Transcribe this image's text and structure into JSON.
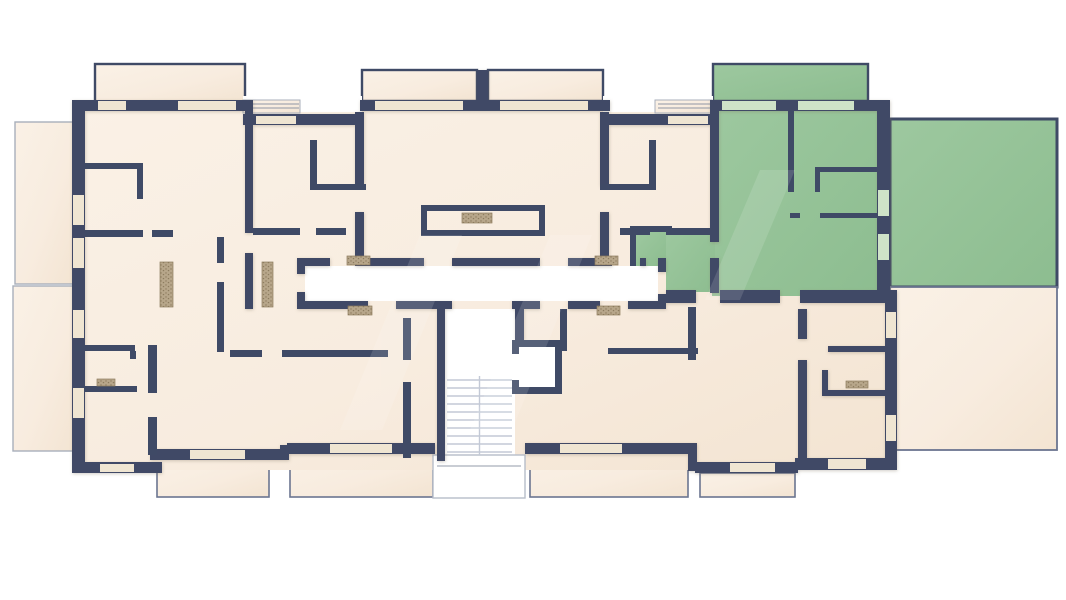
{
  "page": {
    "kind": "architectural-floor-plan",
    "description": "Top-down rendered floor plan of one storey of a residential building. Seven apartment units arranged around a central corridor with staircase and elevator. The upper-right unit and its balcony and large right-hand terrace are highlighted in green (selected/available unit); all other units are beige. Outdoor terraces flank the left side and lower right, balconies line the top and bottom edges. No text labels are rendered on the plan.",
    "background": "#ffffff"
  },
  "colors": {
    "wall": "#3f4a66",
    "wallsoft": "#5b6582",
    "room": "#f8ecdf",
    "roomlight": "#faf1e6",
    "green": "#95c297",
    "greenlight": "#a9cfa9",
    "window": "#efe5d2",
    "windowgreen": "#cfe3c8",
    "thin": "#a9afbb",
    "hatch": "#b7a68a",
    "hatchdot": "#8d7c5f",
    "stair": "#c3c9d6",
    "terraceborder": "#6b7590"
  },
  "regions": {
    "units": [
      {
        "id": "unit-a",
        "position": "left",
        "highlighted": false
      },
      {
        "id": "unit-b",
        "position": "upper-middle-left",
        "highlighted": false
      },
      {
        "id": "unit-c",
        "position": "upper-middle-right",
        "highlighted": false
      },
      {
        "id": "unit-d",
        "position": "upper-right",
        "highlighted": true,
        "highlight_color": "#95c297"
      },
      {
        "id": "unit-e",
        "position": "lower-middle-left",
        "highlighted": false
      },
      {
        "id": "unit-f",
        "position": "lower-middle-right",
        "highlighted": false
      },
      {
        "id": "unit-g",
        "position": "lower-right",
        "highlighted": false
      }
    ],
    "circulation": [
      "central-corridor",
      "staircase",
      "elevator",
      "entrance-porch"
    ],
    "outdoor": [
      "terrace-left-upper",
      "terrace-left-lower",
      "terrace-right-green",
      "terrace-right-lower",
      "balcony-top-left",
      "balcony-top-middle-left",
      "balcony-top-middle-right",
      "balcony-top-right-green",
      "balcony-bottom-1",
      "balcony-bottom-2",
      "balcony-bottom-3",
      "balcony-bottom-4"
    ]
  }
}
